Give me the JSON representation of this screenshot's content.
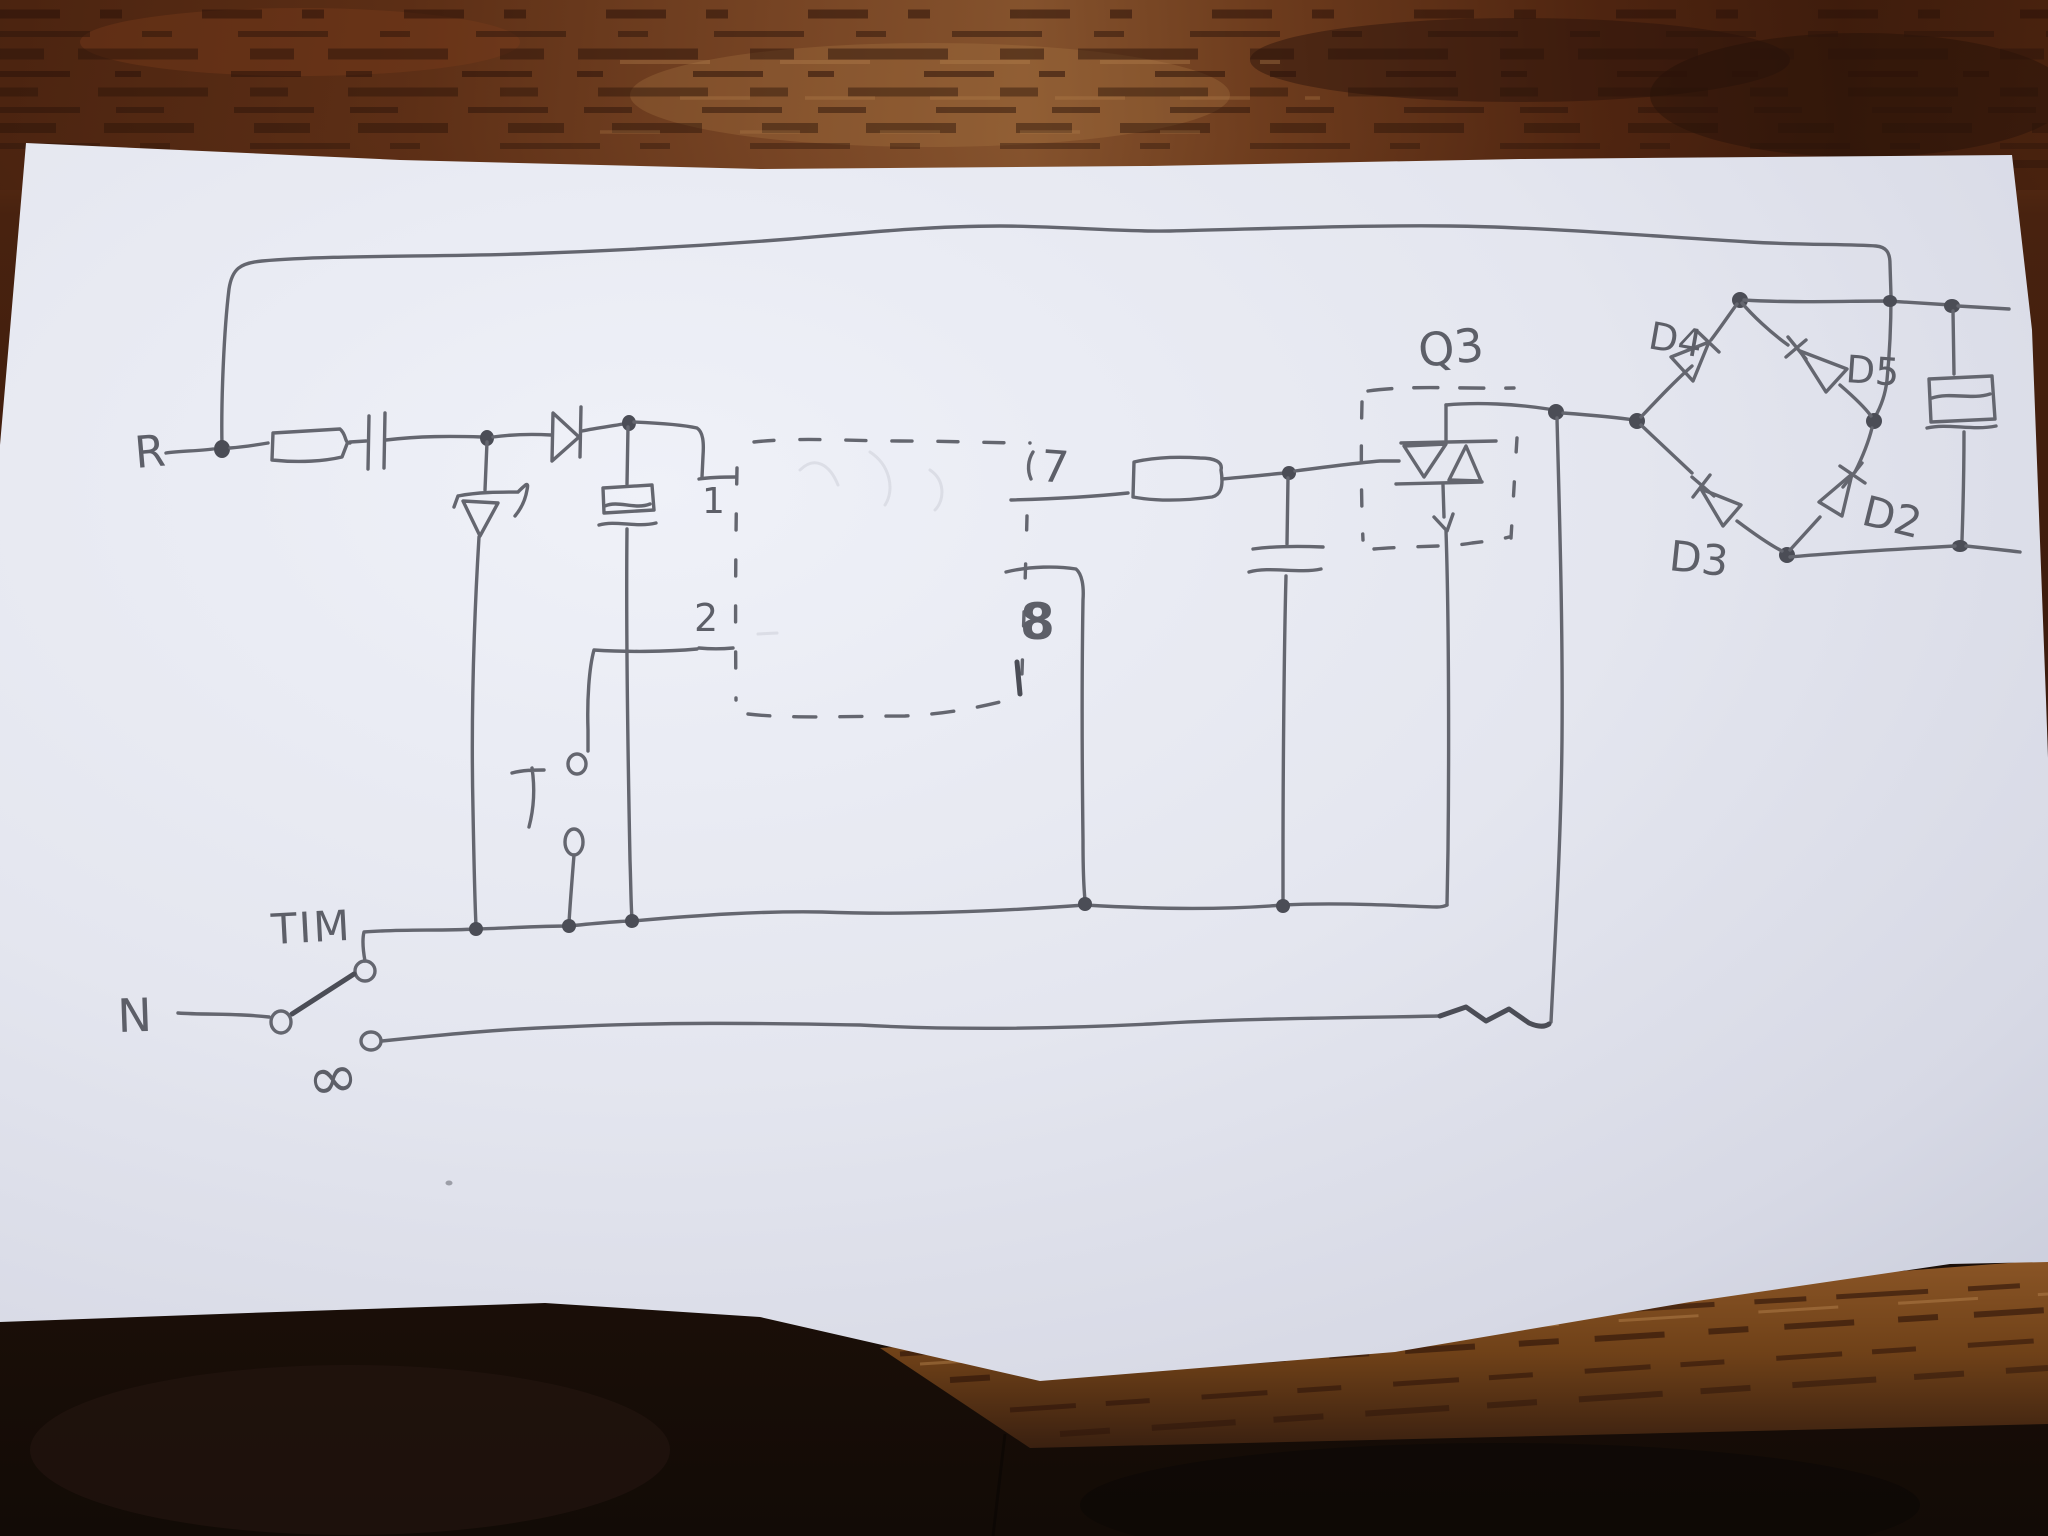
{
  "labels": {
    "line": "R",
    "neutral": "N",
    "timer": "TIM",
    "always_on": "∞",
    "ic_pin_1": "1",
    "ic_pin_2": "2",
    "ic_pin_7": "7",
    "ic_pin_8": "8",
    "triac": "Q3",
    "diode_d2": "D2",
    "diode_d3": "D3",
    "diode_d4": "D4",
    "diode_d5": "D5"
  },
  "colors": {
    "pencil": "#64666f",
    "pencil_dark": "#4b4d56",
    "paper": "#e9ebf3",
    "paper_edge": "#c3c7d6",
    "wood_top_base": "#5d2f16",
    "wood_dark_streak": "#2b1309",
    "wood_light_streak": "#b8854f",
    "wood_bottom_dark": "#150d08",
    "wood_bottom_lit": "#7a4a20"
  }
}
